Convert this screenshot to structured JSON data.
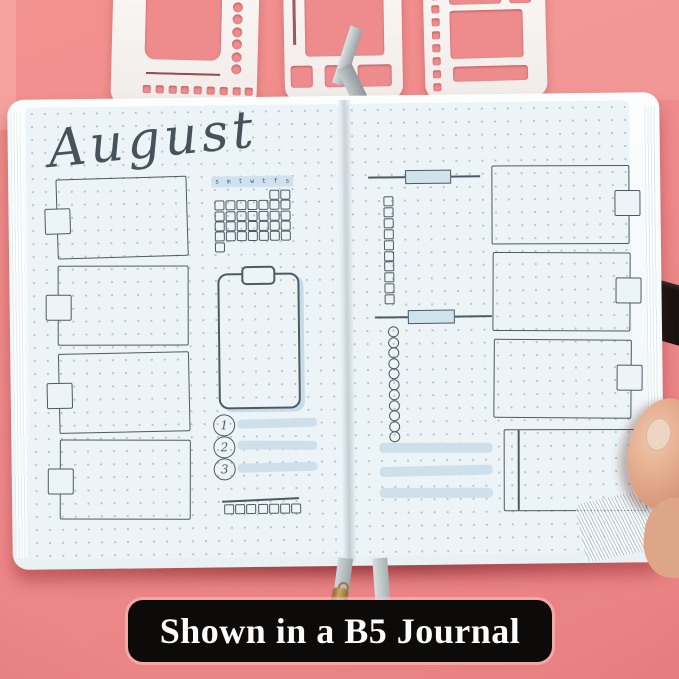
{
  "image_type": "product-photo",
  "caption": {
    "text": "Shown in a B5 Journal"
  },
  "journal": {
    "title": "August",
    "calendar": {
      "day_headers": [
        "s",
        "m",
        "t",
        "w",
        "t",
        "f",
        "s"
      ],
      "days_in_month": 31,
      "start_column": 5
    },
    "numbered_list": [
      "1",
      "2",
      "3"
    ],
    "left_note_boxes": 4,
    "right_note_boxes": 3,
    "checkbox_column_count": 10,
    "circle_column_count": 11,
    "bottom_square_count": 7,
    "highlight_bar_count": 3
  },
  "colors": {
    "background": "#ef8a8b",
    "page": "#ecf4f8",
    "ink": "#4e5a63",
    "highlight": "#cfe3ed",
    "stencil": "#f7f4f1",
    "caption_bg": "#0c0b09",
    "caption_text": "#fbfbfb"
  }
}
